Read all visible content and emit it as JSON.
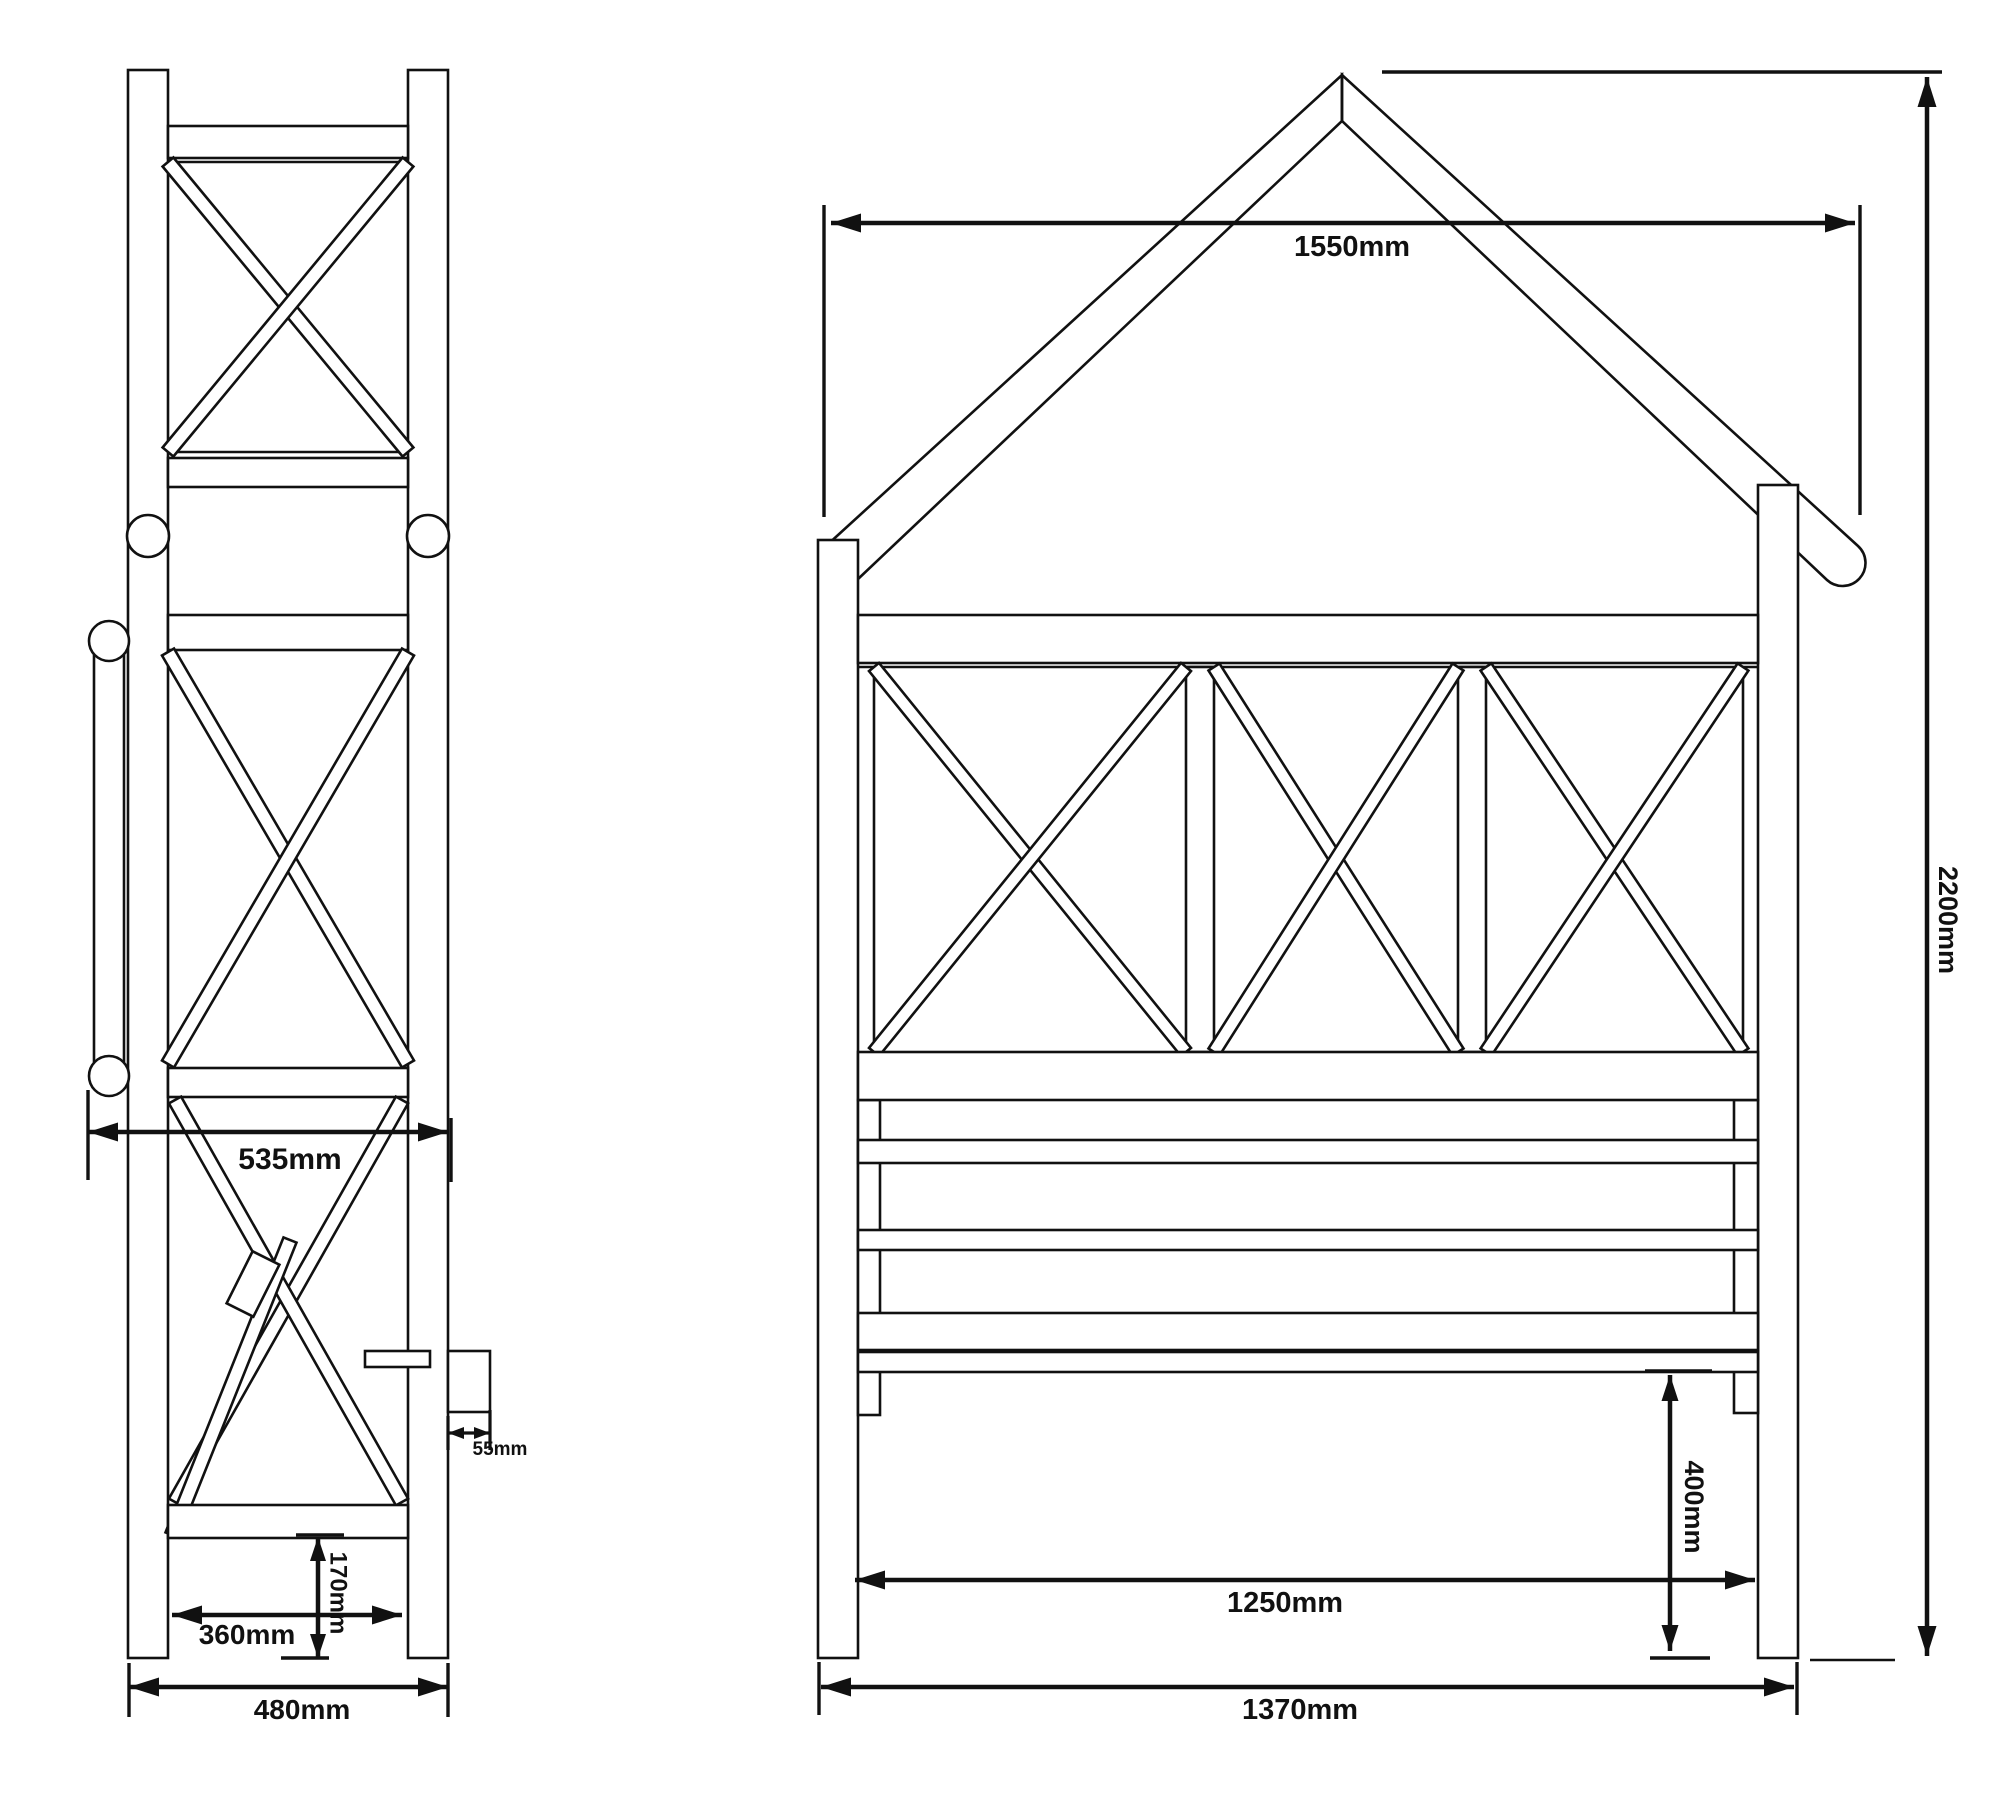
{
  "drawing": {
    "type": "technical-dimension-drawing",
    "subject": "garden arbour bench - side and front elevations",
    "canvas": {
      "width": 2000,
      "height": 1807,
      "background": "#ffffff",
      "line_color": "#111111"
    },
    "structure_stroke": 2.6,
    "dimension_stroke": 4.5,
    "views": {
      "side_elevation": {
        "name": "side-elevation",
        "shapes": [
          {
            "n": "side-post-left",
            "t": "rect",
            "d": [
              128,
              70,
              40,
              1588
            ]
          },
          {
            "n": "side-post-right",
            "t": "rect",
            "d": [
              408,
              70,
              40,
              1588
            ]
          },
          {
            "n": "side-top-rail",
            "t": "rect",
            "d": [
              168,
              126,
              240,
              32
            ]
          },
          {
            "n": "side-upper-panel-top-line",
            "t": "line",
            "d": [
              168,
              162,
              408,
              162
            ]
          },
          {
            "n": "side-upper-panel-bottom-line",
            "t": "line",
            "d": [
              168,
              452,
              408,
              452
            ]
          },
          {
            "n": "side-upper-xbrace-a",
            "t": "band",
            "d": [
              168,
              162,
              408,
              452,
              7
            ]
          },
          {
            "n": "side-upper-xbrace-b",
            "t": "band",
            "d": [
              408,
              162,
              168,
              452,
              7
            ]
          },
          {
            "n": "side-rail-a",
            "t": "rect",
            "d": [
              168,
              458,
              240,
              29
            ]
          },
          {
            "n": "side-peg-left",
            "t": "circle",
            "d": [
              148,
              536,
              21
            ]
          },
          {
            "n": "side-peg-right",
            "t": "circle",
            "d": [
              428,
              536,
              21
            ]
          },
          {
            "n": "side-rail-b",
            "t": "rect",
            "d": [
              168,
              615,
              240,
              35
            ]
          },
          {
            "n": "side-lower-xbrace-a",
            "t": "band",
            "d": [
              168,
              652,
              408,
              1064,
              7
            ]
          },
          {
            "n": "side-lower-xbrace-b",
            "t": "band",
            "d": [
              408,
              652,
              168,
              1064,
              7
            ]
          },
          {
            "n": "side-seat-rail",
            "t": "rect",
            "d": [
              168,
              1068,
              240,
              29
            ]
          },
          {
            "n": "side-armrest-bar",
            "t": "rect",
            "d": [
              94,
              641,
              30,
              435
            ]
          },
          {
            "n": "side-armrest-knob-top",
            "t": "circle",
            "d": [
              109,
              641,
              20
            ]
          },
          {
            "n": "side-armrest-knob-bottom",
            "t": "circle",
            "d": [
              109,
              1076,
              20
            ]
          },
          {
            "n": "side-underseat-brace-a",
            "t": "band",
            "d": [
              175,
              1502,
              402,
              1100,
              7
            ]
          },
          {
            "n": "side-underseat-brace-b",
            "t": "band",
            "d": [
              402,
              1502,
              175,
              1100,
              7
            ]
          },
          {
            "n": "side-underseat-brace-steep",
            "t": "band",
            "d": [
              172,
              1535,
              290,
              1240,
              7
            ]
          },
          {
            "n": "side-seat-slat-piece-a",
            "t": "band",
            "d": [
              240,
              1310,
              266,
              1258,
              15
            ]
          },
          {
            "n": "side-seat-slat-piece-b",
            "t": "rect",
            "d": [
              365,
              1351,
              65,
              16
            ]
          },
          {
            "n": "side-rear-protrusion",
            "t": "rect",
            "d": [
              448,
              1351,
              42,
              61
            ]
          },
          {
            "n": "side-bottom-rail",
            "t": "rect",
            "d": [
              168,
              1505,
              240,
              33
            ]
          }
        ]
      },
      "front_elevation": {
        "name": "front-elevation",
        "shapes": [
          {
            "n": "front-roof-bargeboard-left",
            "t": "path",
            "d": "M 1342 75 L 826 546 A 18 18 0 0 0 857 580 L 1342 121 Z"
          },
          {
            "n": "front-roof-bargeboard-right",
            "t": "path",
            "d": "M 1342 75 L 1858 546 A 18 18 0 0 1 1827 580 L 1342 121 Z"
          },
          {
            "n": "front-roof-ridge-joint",
            "t": "line",
            "d": [
              1342,
              75,
              1342,
              121
            ]
          },
          {
            "n": "front-post-left",
            "t": "rect",
            "d": [
              818,
              540,
              40,
              1118
            ]
          },
          {
            "n": "front-post-right",
            "t": "rect",
            "d": [
              1758,
              485,
              40,
              1173
            ]
          },
          {
            "n": "front-seat-leg-left",
            "t": "rect",
            "d": [
              858,
              1100,
              22,
              315
            ]
          },
          {
            "n": "front-seat-leg-right",
            "t": "rect",
            "d": [
              1734,
              1100,
              24,
              313
            ]
          },
          {
            "n": "front-header-rail",
            "t": "rect",
            "d": [
              858,
              615,
              900,
              48
            ]
          },
          {
            "n": "front-lattice-top-line",
            "t": "line",
            "d": [
              858,
              667,
              1758,
              667
            ]
          },
          {
            "n": "front-lattice-stile-left",
            "t": "line",
            "d": [
              874,
              667,
              874,
              1052
            ]
          },
          {
            "n": "front-lattice-stile-right",
            "t": "line",
            "d": [
              1743,
              667,
              1743,
              1052
            ]
          },
          {
            "n": "front-lattice-divider-1",
            "t": "rect",
            "d": [
              1186,
              667,
              28,
              385
            ]
          },
          {
            "n": "front-lattice-divider-2",
            "t": "rect",
            "d": [
              1458,
              667,
              28,
              385
            ]
          },
          {
            "n": "front-lattice-x1a",
            "t": "band",
            "d": [
              874,
              667,
              1186,
              1052,
              6.5
            ]
          },
          {
            "n": "front-lattice-x1b",
            "t": "band",
            "d": [
              1186,
              667,
              874,
              1052,
              6.5
            ]
          },
          {
            "n": "front-lattice-x2a",
            "t": "band",
            "d": [
              1214,
              667,
              1458,
              1052,
              6.5
            ]
          },
          {
            "n": "front-lattice-x2b",
            "t": "band",
            "d": [
              1458,
              667,
              1214,
              1052,
              6.5
            ]
          },
          {
            "n": "front-lattice-x3a",
            "t": "band",
            "d": [
              1486,
              667,
              1743,
              1052,
              6.5
            ]
          },
          {
            "n": "front-lattice-x3b",
            "t": "band",
            "d": [
              1743,
              667,
              1486,
              1052,
              6.5
            ]
          },
          {
            "n": "front-backrest-top-rail",
            "t": "rect",
            "d": [
              858,
              1052,
              900,
              48
            ]
          },
          {
            "n": "front-back-slat-1",
            "t": "rect",
            "d": [
              858,
              1140,
              900,
              23
            ]
          },
          {
            "n": "front-back-slat-2",
            "t": "rect",
            "d": [
              858,
              1230,
              900,
              20
            ]
          },
          {
            "n": "front-seat-slat-band",
            "t": "rect",
            "d": [
              858,
              1313,
              900,
              37
            ]
          },
          {
            "n": "front-seat-front-rail",
            "t": "rect",
            "d": [
              858,
              1352,
              900,
              20
            ]
          },
          {
            "n": "front-ground-line-right",
            "t": "line",
            "d": [
              1810,
              1660,
              1895,
              1660
            ]
          }
        ]
      }
    },
    "dimensions": [
      {
        "n": "dim-535mm",
        "label": "535mm",
        "line": [
          88,
          1132,
          448,
          1132
        ],
        "ext": [
          [
            88,
            1090,
            88,
            1180
          ],
          [
            451,
            1118,
            451,
            1182
          ]
        ],
        "lxy": [
          290,
          1148
        ],
        "rot": 0,
        "fs": 30
      },
      {
        "n": "dim-55mm",
        "label": "55mm",
        "line": [
          448,
          1433,
          490,
          1433
        ],
        "sw": 3.2,
        "arrow": [
          16,
          6
        ],
        "ext": [
          [
            448,
            1416,
            448,
            1450
          ],
          [
            490,
            1410,
            490,
            1450
          ]
        ],
        "lxy": [
          500,
          1442
        ],
        "rot": 0,
        "fs": 19
      },
      {
        "n": "dim-170mm",
        "label": "170mm",
        "line": [
          318,
          1537,
          318,
          1658
        ],
        "arrow": [
          24,
          8
        ],
        "ext": [
          [
            296,
            1535,
            344,
            1535
          ],
          [
            281,
            1658,
            329,
            1658
          ]
        ],
        "lxy": [
          338,
          1593
        ],
        "rot": 90,
        "fs": 24
      },
      {
        "n": "dim-360mm",
        "label": "360mm",
        "line": [
          172,
          1615,
          402,
          1615
        ],
        "ext": [],
        "lxy": [
          247,
          1624
        ],
        "rot": 0,
        "fs": 28
      },
      {
        "n": "dim-480mm",
        "label": "480mm",
        "line": [
          129,
          1687,
          448,
          1687
        ],
        "ext": [
          [
            129,
            1663,
            129,
            1717
          ],
          [
            448,
            1663,
            448,
            1717
          ]
        ],
        "lxy": [
          302,
          1699
        ],
        "rot": 0,
        "fs": 28
      },
      {
        "n": "dim-1550mm",
        "label": "1550mm",
        "line": [
          831,
          223,
          1855,
          223
        ],
        "ext": [
          [
            824,
            205,
            824,
            517
          ],
          [
            1860,
            205,
            1860,
            515
          ]
        ],
        "lxy": [
          1352,
          236
        ],
        "rot": 0,
        "fs": 29
      },
      {
        "n": "dim-2200mm",
        "label": "2200mm",
        "line": [
          1927,
          77,
          1927,
          1656
        ],
        "ext": [
          [
            1382,
            72,
            1942,
            72
          ]
        ],
        "lxy": [
          1948,
          920
        ],
        "rot": 90,
        "fs": 27
      },
      {
        "n": "dim-400mm",
        "label": "400mm",
        "line": [
          1670,
          1375,
          1670,
          1651
        ],
        "arrow": [
          26,
          8.5
        ],
        "ext": [
          [
            1645,
            1371,
            1712,
            1371
          ],
          [
            1650,
            1658,
            1710,
            1658
          ]
        ],
        "lxy": [
          1694,
          1507
        ],
        "rot": 90,
        "fs": 27
      },
      {
        "n": "dim-1250mm",
        "label": "1250mm",
        "line": [
          855,
          1580,
          1755,
          1580
        ],
        "ext": [],
        "lxy": [
          1285,
          1592
        ],
        "rot": 0,
        "fs": 29
      },
      {
        "n": "dim-1370mm",
        "label": "1370mm",
        "line": [
          821,
          1687,
          1794,
          1687
        ],
        "ext": [
          [
            819,
            1662,
            819,
            1715
          ],
          [
            1797,
            1662,
            1797,
            1715
          ]
        ],
        "lxy": [
          1300,
          1699
        ],
        "rot": 0,
        "fs": 29
      }
    ]
  }
}
